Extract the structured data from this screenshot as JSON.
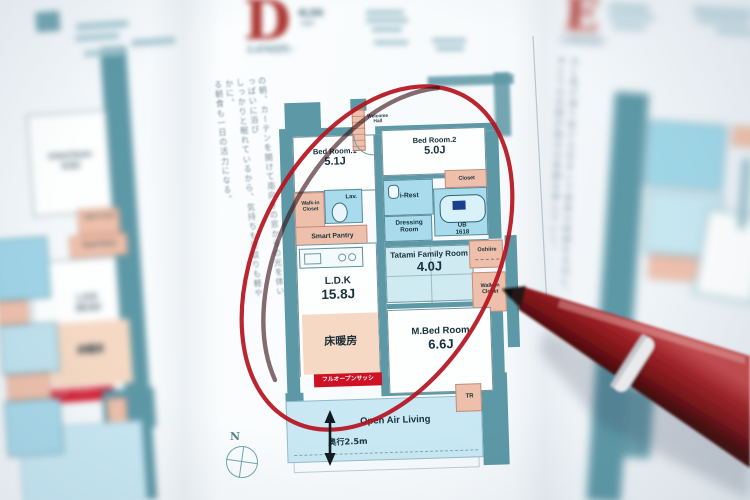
{
  "colors": {
    "wall_teal": "#5d98a6",
    "wet_blue": "#a8dcec",
    "tatami_blue": "#cfeaf0",
    "closet_pink": "#eec0ab",
    "heating_peach": "#f5d9c4",
    "balcony_blue": "#c9e8f4",
    "marker_circle_red": "#b5121d",
    "ribbon_red": "#cf1126",
    "pen_body_red": "#8e1b20",
    "ink": "#17313d"
  },
  "header_d": {
    "letter": "D",
    "type": "4LDK",
    "type_sub": "type",
    "price": "2,470万円~"
  },
  "header_e": {
    "letter": "E",
    "price": "2,860万円~"
  },
  "copy_left": {
    "col1": "の朝、カーテンを開けて南向きの窓からの光を体いっぱいに浴び",
    "col2": "しっかりと眠れているから、気持ちも足取りも軽やかに。",
    "col3": "る朝食も一日の活力になる。"
  },
  "copy_right_illegible_approximation": {
    "col1": "光と風が通り抜ける住まいで家族の時間を大切に。",
    "col2": "ゆとりの空間が毎日の笑顔を育んでいく。"
  },
  "plan_d": {
    "compass": "N",
    "rooms": {
      "bedroom1": {
        "name": "Bed Room.1",
        "size": "5.1J"
      },
      "bedroom2": {
        "name": "Bed Room.2",
        "size": "5.0J"
      },
      "welcome_hall": "Welcome Hall",
      "walkin_closet": "Walk-in Closet",
      "lav": "Lav.",
      "smart_pantry": "Smart Pantry",
      "i_rest": "i-Rest",
      "closet": "Closet",
      "ub": {
        "name": "UB",
        "size": "1618"
      },
      "dressing_room": "Dressing Room",
      "tatami": {
        "name": "Tatami Family Room",
        "size": "4.0J"
      },
      "oshiire": "Oshiire",
      "walkin_closet_right": "Walk-in Closet",
      "ldk": {
        "name": "L.D.K",
        "size": "15.8J"
      },
      "floor_heating": "床暖房",
      "sash_ribbon": "フルオープンサッシ",
      "m_bedroom": {
        "name": "M.Bed Room",
        "size": "6.6J"
      },
      "balcony": {
        "name": "Open Air Living",
        "depth": "奥行2.5m"
      },
      "trunk": "TR"
    }
  },
  "plan_left": {
    "bedroom": {
      "name": "M.Bed Room",
      "size": "6.5J"
    },
    "walkin_closet": "Walk-in Closet",
    "smart_pantry": "Smart Pantry",
    "ldk": {
      "name": "L.D.K",
      "size": "15.5J"
    },
    "floor_heating": "床暖房",
    "sash_ribbon": "フルオープンサッシ"
  }
}
